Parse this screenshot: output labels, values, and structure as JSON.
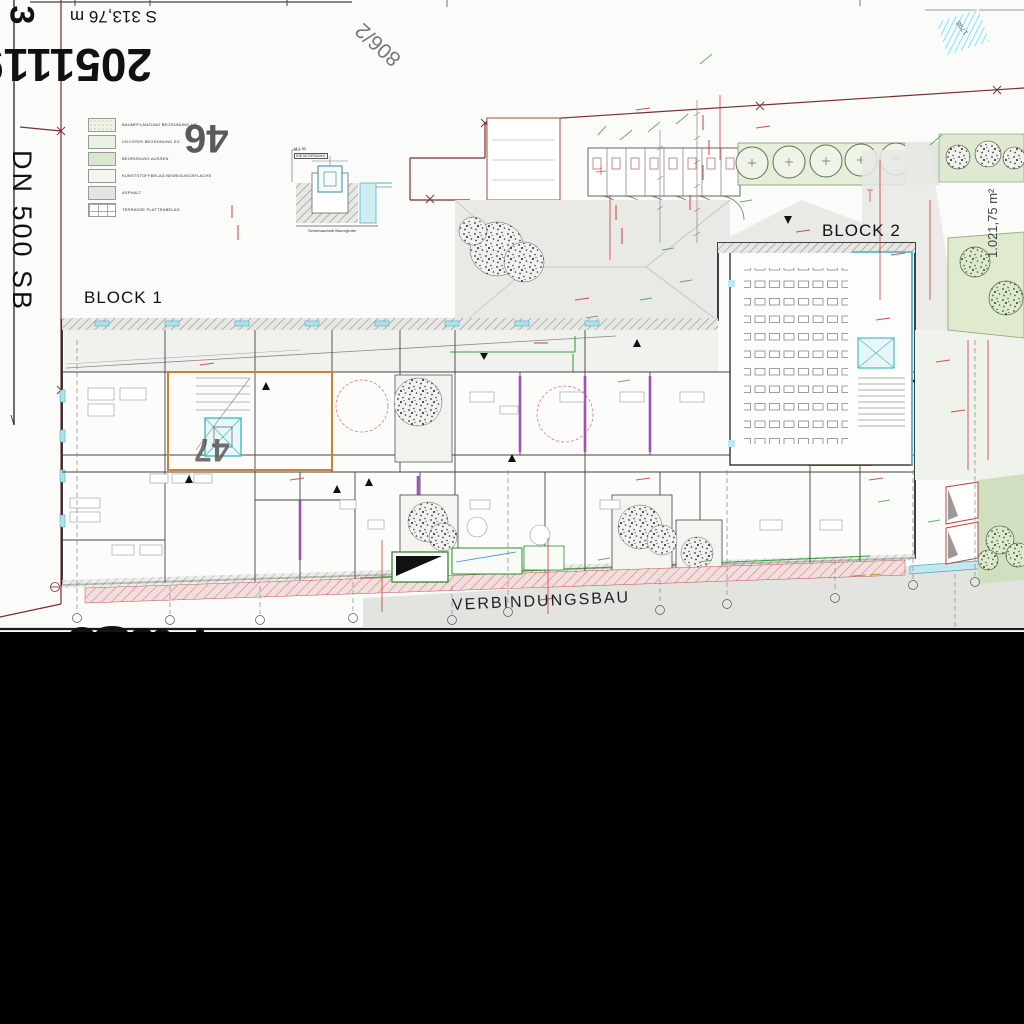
{
  "sheet": {
    "labels": {
      "block1": "BLOCK 1",
      "block2": "BLOCK 2",
      "verbindungsbau": "VERBINDUNGSBAU",
      "parcel_46": "46",
      "parcel_47": "47",
      "parcel_806_2": "806/2",
      "parcel_1798": "1798",
      "area_right": "1.021,75 m²",
      "survey_number": "2051119",
      "survey_length": "S 313,76 m",
      "pipe_label": "DN 500  SB",
      "margin_digit": "3"
    },
    "legend": {
      "items": [
        {
          "label": "BAUMPFLANZUNG BEGRÜNUNG UG",
          "color": "#eef3e6",
          "pattern": "dots"
        },
        {
          "label": "LEICHTER BEGRÜNUNG EG",
          "color": "#e9f2e4",
          "pattern": "solid"
        },
        {
          "label": "BEGRÜNUNG AUSSEN",
          "color": "#d8e7cf",
          "pattern": "solid"
        },
        {
          "label": "KUNSTSTOFFBELAG BEWEGUNGSFLÄCHE",
          "color": "#f7f5f1",
          "pattern": "solid"
        },
        {
          "label": "ASPHALT",
          "color": "#e4e4e2",
          "pattern": "solid"
        },
        {
          "label": "TERRASSE PLATTENBELAG",
          "color": "#ffffff",
          "pattern": "grid"
        }
      ]
    },
    "detail": {
      "scale_note": "M 1:50",
      "ref_note": "KIESKÖRNUNG",
      "caption": "Schemaschnitt Baumgrube"
    },
    "colors": {
      "boundary_red": "#7a2e2e",
      "annotation_red": "#cc3333",
      "annotation_green": "#3aa33a",
      "wall_cyan": "#49b8c8",
      "wall_orange": "#c8813c",
      "wall_purple": "#a050b8",
      "asphalt_gray": "#e3e3e0"
    }
  }
}
